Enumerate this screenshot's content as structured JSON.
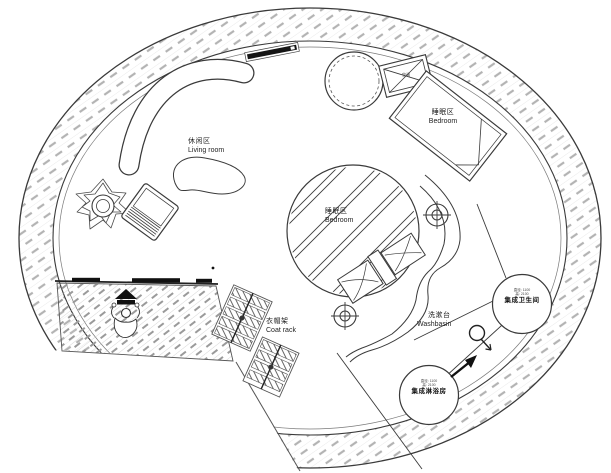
{
  "drawing": {
    "type": "architectural-floor-plan",
    "shape": "circular-pod-house",
    "colors": {
      "background": "#ffffff",
      "line": "#3a3a3a",
      "hatch_wall": "#b3b3b3",
      "hatch_floor": "#9a9a9a",
      "door_fill": "#111111",
      "text": "#1f1f1f"
    },
    "zones": {
      "living_room": {
        "zh": "休闲区",
        "en": "Living room"
      },
      "bedroom_upper": {
        "zh": "睡眠区",
        "en": "Bedroom"
      },
      "bedroom_center": {
        "zh": "睡眠区",
        "en": "Bedroom"
      },
      "coat_rack": {
        "zh": "衣帽架",
        "en": "Coat rack"
      },
      "washbasin": {
        "zh": "洗漱台",
        "en": "Washbasin"
      },
      "bathroom_pod": {
        "name": "集成卫生间",
        "spec1": "直径: 1100",
        "spec2": "高: 2100"
      },
      "shower_pod": {
        "name": "集成淋浴房",
        "spec1": "直径: 1100",
        "spec2": "高: 2100"
      },
      "ac_unit": {
        "zh": "空调"
      }
    }
  }
}
